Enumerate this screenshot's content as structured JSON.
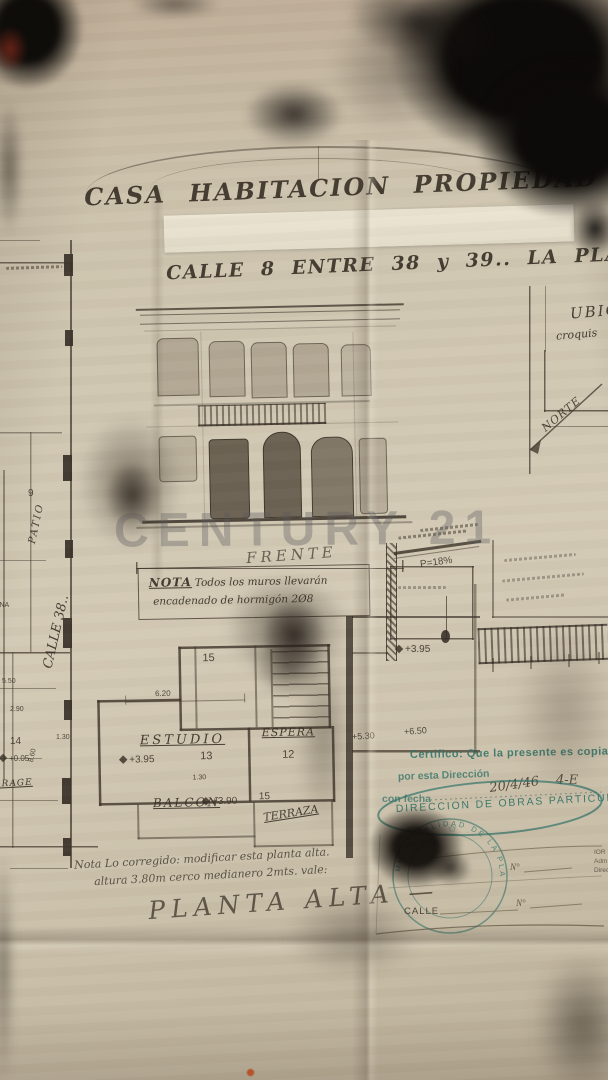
{
  "header": {
    "title": "CASA HABITACION PROPIEDAD DEL DOCTOR",
    "address": "CALLE 8 ENTRE 38 y 39.. LA PLATA.. ESC:="
  },
  "watermark": "CENTURY 21",
  "site_sketch": {
    "title": "UBICA",
    "subtitle": "croquis",
    "north": "NORTE"
  },
  "left_plan": {
    "street": "CALLE 38..",
    "patio": "PATIO",
    "cocina": "COCINA",
    "room9": "9",
    "room14": "14",
    "garage": "GARAGE",
    "level": "+0.05",
    "dim1": "5.50",
    "dim2": "2.90",
    "dim3": "8.60",
    "dim4": "1.30"
  },
  "elevation": {
    "caption": "FRENTE"
  },
  "nota": {
    "label": "NOTA",
    "line1": "Todos los muros llevarán",
    "line2": "encadenado de hormigón 2Ø8"
  },
  "section": {
    "slope": "P=18%",
    "level": "+3.95"
  },
  "upper_plan": {
    "estudio": "ESTUDIO",
    "espera": "ESPERA",
    "balcon": "BALCON",
    "terraza": "TERRAZA",
    "room15": "15",
    "room13": "13",
    "room12": "12",
    "room15b": "15",
    "level_395": "+3.95",
    "level_390": "+3.90",
    "dim_620": "6.20",
    "dim_130": "1.30"
  },
  "marks": {
    "l650": "+6.50",
    "l530": "+5.30"
  },
  "stamps": {
    "certify1": "Certifico: Que la presente es copia",
    "certify2": "por esta Dirección",
    "certify3": "con fecha",
    "date": "20/4/46",
    "ref": "4-E",
    "office": "DIRECCION DE OBRAS PARTICULARES",
    "round": "MUNICIPALIDAD DE LA PLATA",
    "de_exp": "DE EXP.",
    "n1": "N°",
    "calle": "CALLE",
    "n2": "N°",
    "frag1": "IOR",
    "frag2": "Adm",
    "frag3": "Direc"
  },
  "footer": {
    "note1": "Nota Lo corregido: modificar esta planta alta.",
    "note2": "altura 3.80m cerco medianero 2mts. vale:",
    "plan_title": "PLANTA ALTA —"
  }
}
